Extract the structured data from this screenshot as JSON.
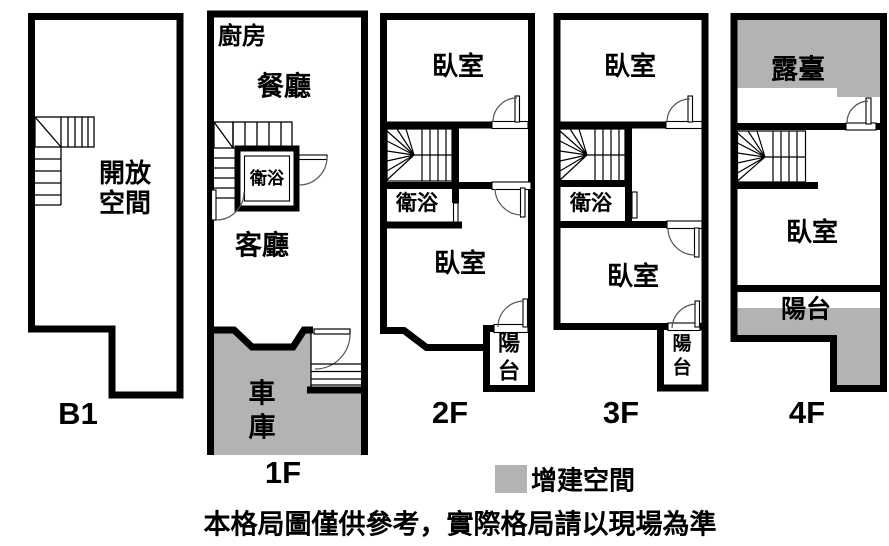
{
  "colors": {
    "added_space": "#b3b3b3",
    "wall": "#000000",
    "background": "#ffffff"
  },
  "floors": {
    "b1": {
      "label": "B1",
      "rooms": {
        "open_space": "開放空間"
      }
    },
    "f1": {
      "label": "1F",
      "rooms": {
        "kitchen": "廚房",
        "dining": "餐廳",
        "bathroom": "衛浴",
        "living": "客廳",
        "garage": "車庫"
      }
    },
    "f2": {
      "label": "2F",
      "rooms": {
        "bedroom_top": "臥室",
        "bathroom": "衛浴",
        "bedroom_bottom": "臥室",
        "balcony": "陽台"
      }
    },
    "f3": {
      "label": "3F",
      "rooms": {
        "bedroom_top": "臥室",
        "bathroom": "衛浴",
        "bedroom_bottom": "臥室",
        "balcony": "陽台"
      }
    },
    "f4": {
      "label": "4F",
      "rooms": {
        "terrace": "露臺",
        "bedroom": "臥室",
        "balcony": "陽台"
      }
    }
  },
  "legend": {
    "added_space_label": "增建空間"
  },
  "caption": "本格局圖僅供參考，實際格局請以現場為準"
}
